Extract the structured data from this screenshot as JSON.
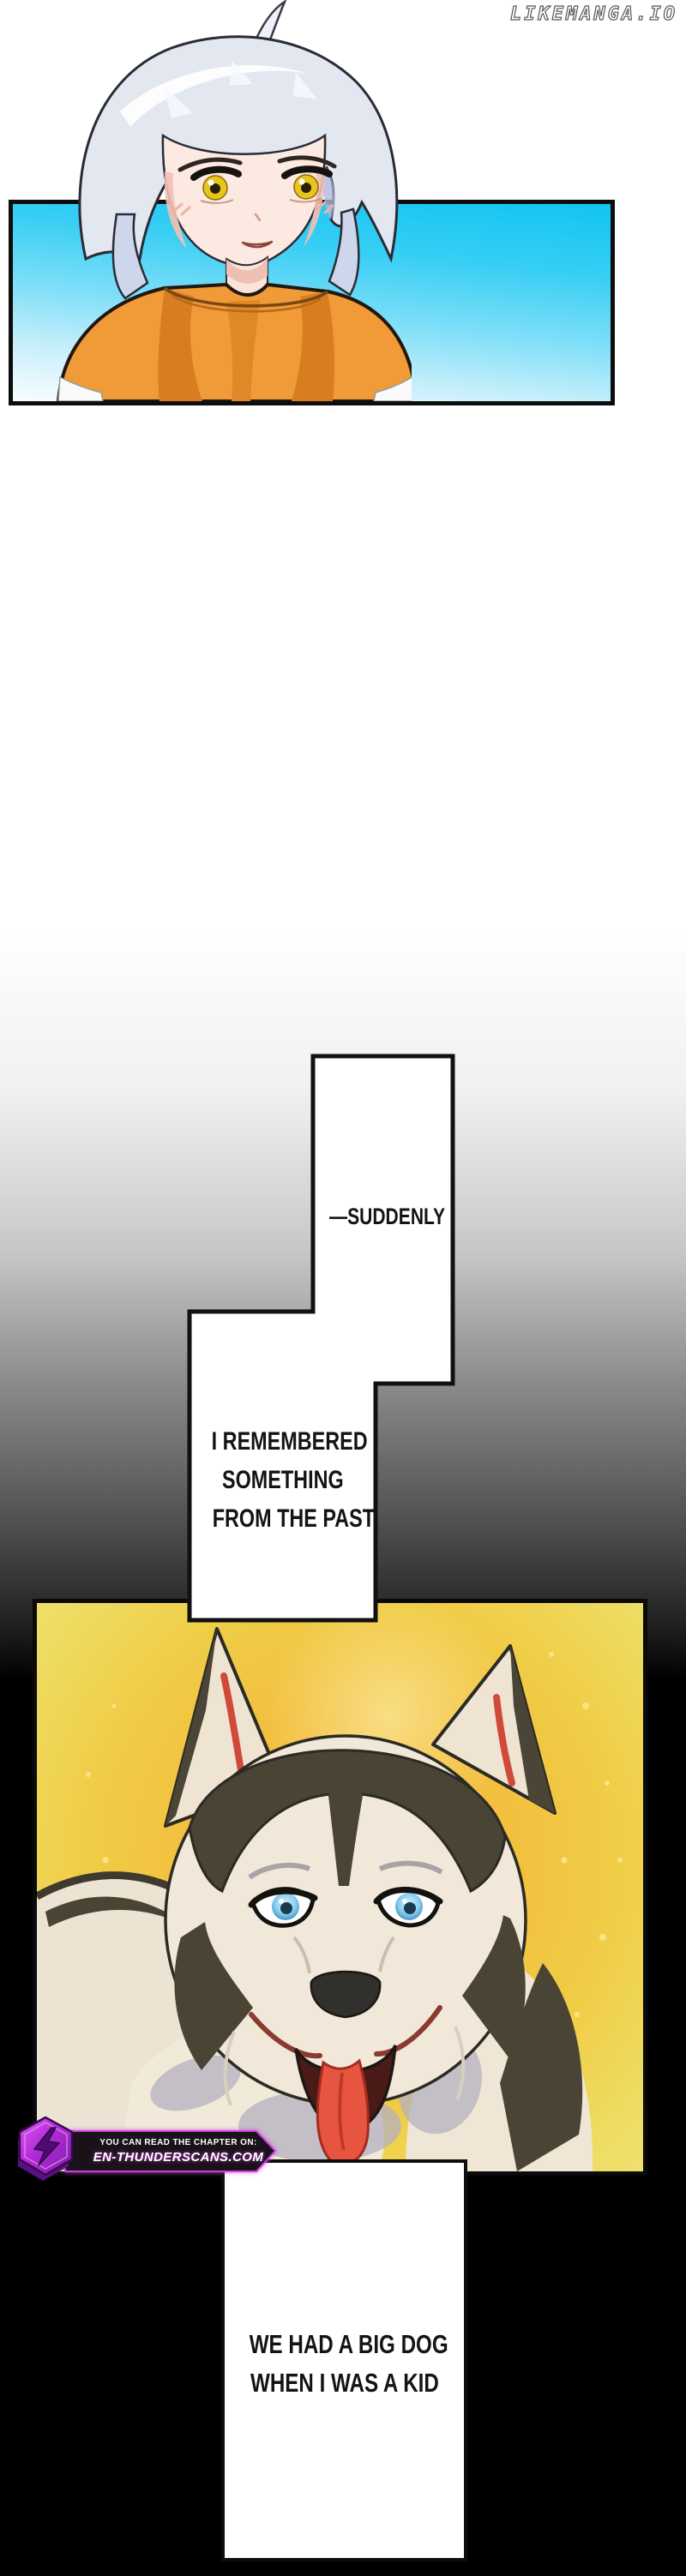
{
  "watermark": "LIKEMANGA.IO",
  "speech": {
    "suddenly": "—SUDDENLY",
    "remembered": {
      "line1": "I REMEMBERED",
      "line2": "SOMETHING",
      "line3": "FROM THE PAST"
    },
    "bigdog": {
      "line1": "WE HAD A BIG DOG",
      "line2": "WHEN I WAS A KID"
    }
  },
  "badge": {
    "line1": "YOU CAN READ THE CHAPTER ON:",
    "line2": "EN-THUNDERSCANS.COM"
  },
  "colors": {
    "sky_top": "#12c5f2",
    "sky_bottom": "#f7fdff",
    "hoodie_orange": "#f09a38",
    "hair_silver": "#e3e7ef",
    "eye_yellow": "#e7c51d",
    "panel_yellow": "#f0cd47",
    "panel_gold_center": "#f7b33a",
    "dog_dark_fur": "#4a4435",
    "dog_cream_fur": "#f1e8d9",
    "dog_eye_blue": "#8ed0f0",
    "tongue_red": "#e7543f",
    "badge_purple": "#c63ae8",
    "badge_dark": "#191219",
    "page_black": "#000000",
    "box_white": "#ffffff",
    "border_black": "#0d0d0d"
  }
}
